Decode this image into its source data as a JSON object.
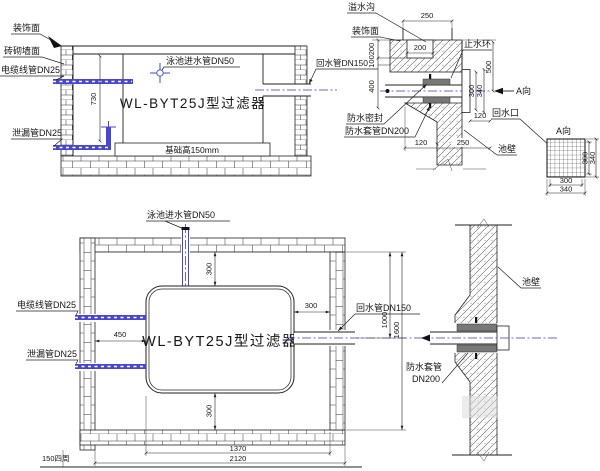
{
  "colors": {
    "background": "#ffffff",
    "line": "#222222",
    "pipe_blue": "#4747cf",
    "centerline_blue": "#3a3ad0",
    "seal_gray": "#787878"
  },
  "section": {
    "decor_face": "装饰面",
    "brick_wall": "砖砌墙面",
    "cable_conduit": "电缆线管DN25",
    "leak_pipe": "泄漏管DN25",
    "pool_inlet": "泳池进水管DN50",
    "filter_name": "WL-BYT25J型过滤器",
    "return_pipe": "回水管DN150",
    "foundation": "基础高150mm",
    "d730": "730"
  },
  "detail": {
    "overflow_gutter": "溢水沟",
    "decor_face": "装饰面",
    "waterstop_ring": "止水环",
    "waterproof_seal": "防水密封",
    "waterproof_sleeve": "防水套管DN200",
    "return_outlet": "回水口",
    "pool_wall": "池壁",
    "view_a": "A向",
    "d250_top": "250",
    "d200_notch": "200",
    "d200": "200",
    "d100": "100",
    "d400": "400",
    "d500": "500",
    "d300": "300",
    "d340": "340",
    "d120_right": "120",
    "d120_left": "120",
    "d250_wall": "250"
  },
  "grid": {
    "view_a": "A向",
    "d300_side": "300",
    "d340_side": "340",
    "d300_bottom": "300",
    "d340_bottom": "340"
  },
  "plan": {
    "pool_inlet": "泳池进水管DN50",
    "cable_conduit": "电缆线管DN25",
    "leak_pipe": "泄漏管DN25",
    "filter_name": "WL-BYT25J型过滤器",
    "return_pipe": "回水管DN150",
    "d300_top": "300",
    "d450": "450",
    "d300_right": "300",
    "d300_bottom": "300",
    "d1000": "1000",
    "d1600": "1600",
    "d1370": "1370",
    "d2120": "2120",
    "d150": "150四周"
  },
  "wall_detail": {
    "pool_wall": "池壁",
    "sleeve_line1": "防水套管",
    "sleeve_line2": "DN200"
  }
}
